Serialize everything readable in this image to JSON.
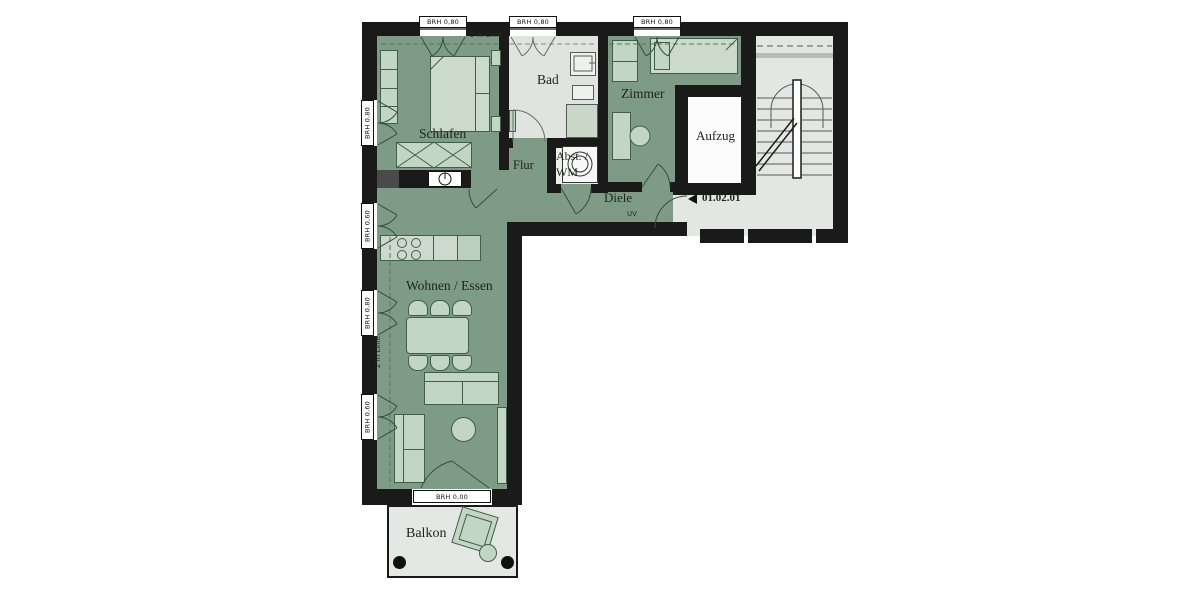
{
  "floorplan": {
    "unit_label": "01.02.01",
    "rooms": {
      "schlafen": "Schlafen",
      "bad": "Bad",
      "zimmer": "Zimmer",
      "aufzug": "Aufzug",
      "flur": "Flur",
      "abstellraum_line1": "Abst. /",
      "abstellraum_line2": "WM",
      "diele": "Diele",
      "wohnen_essen": "Wohnen / Essen",
      "balkon": "Balkon"
    },
    "window_labels": {
      "top": [
        "BRH 0,80",
        "BRH 0,80",
        "BRH 0,80"
      ],
      "left": [
        "BRH 0,80",
        "BRH 0,60",
        "BRH 0,80",
        "BRH 0,60"
      ],
      "balcony_door": "BRH 0,00"
    },
    "annotations": {
      "two_m_line_top": "2 m Linie",
      "two_m_line_left": "2 m Linie",
      "uv": "UV"
    },
    "colors": {
      "wall": "#1a1a1a",
      "room_green": "#7e9c85",
      "room_gray": "#e3e7e4",
      "bad_gray": "#dfe4e1",
      "furniture_fill": "#c3d5c3",
      "furniture_outline": "#3f5f49",
      "background": "#ffffff"
    }
  }
}
